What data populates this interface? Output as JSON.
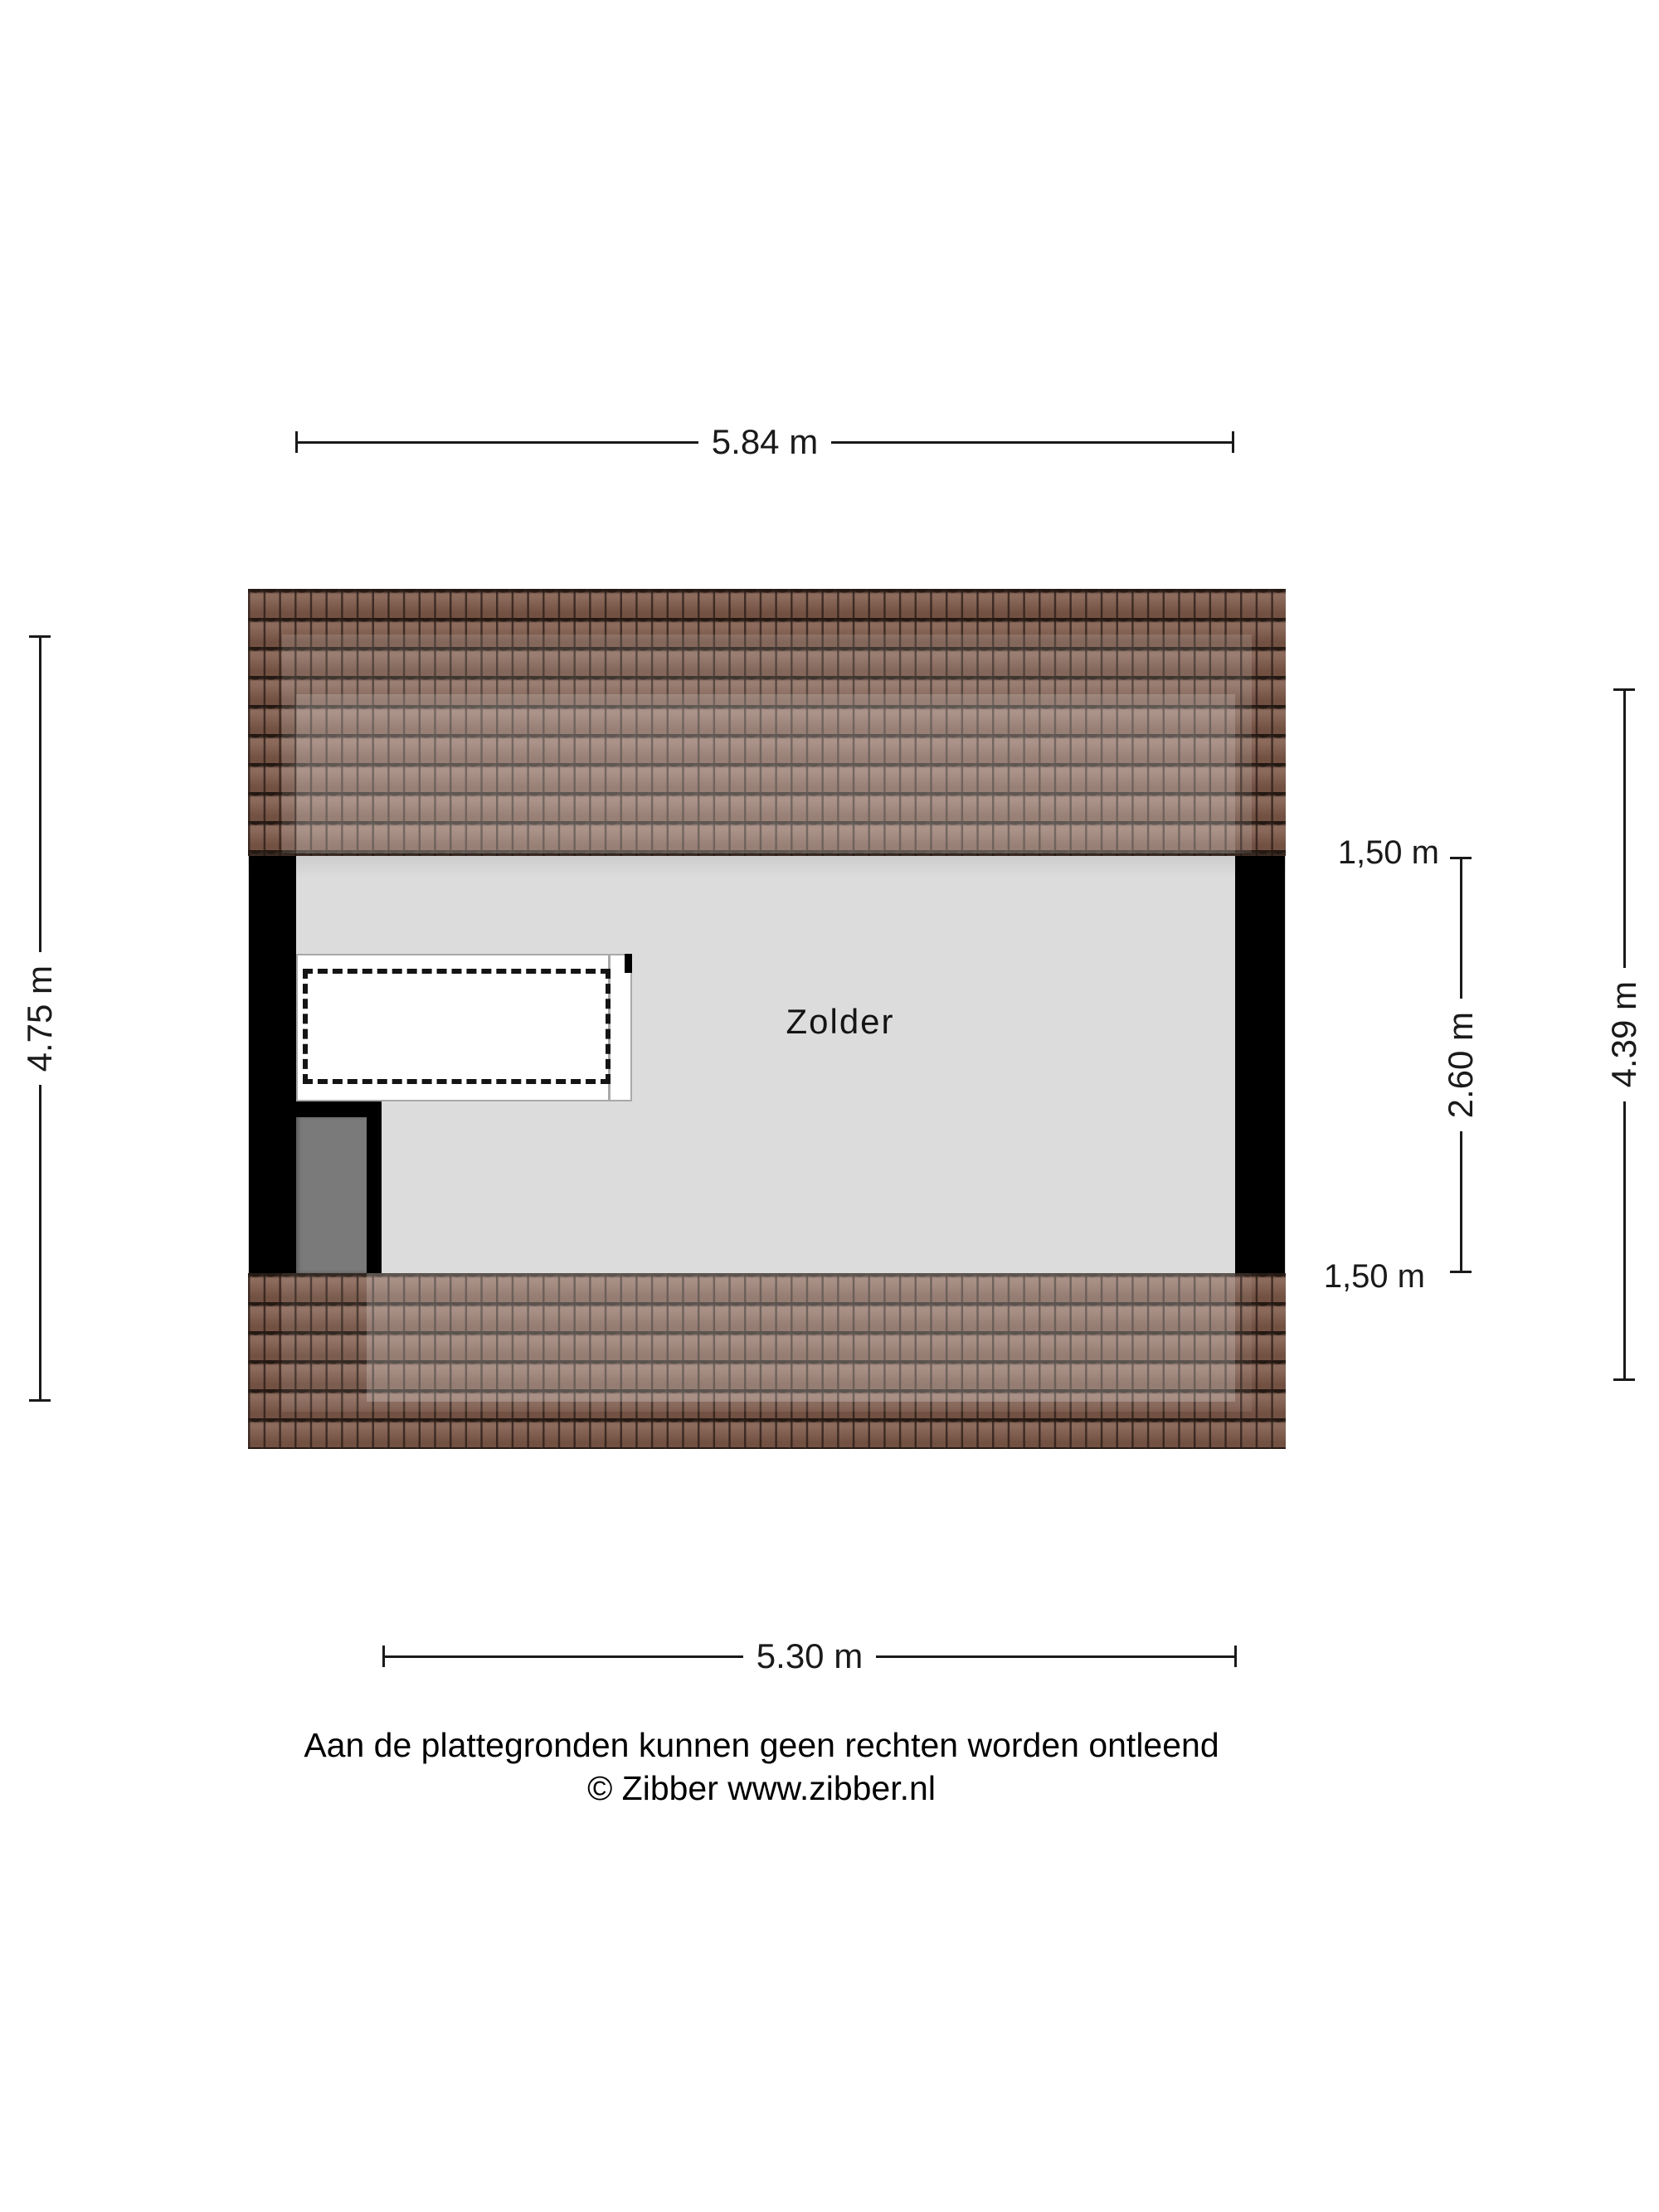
{
  "floorplan": {
    "room_label": "Zolder",
    "dimensions": {
      "top_width": "5.84 m",
      "bottom_width": "5.30 m",
      "left_height": "4.75 m",
      "right_height": "4.39 m",
      "headroom_top": "1,50 m",
      "ceiling_height": "2.60 m",
      "headroom_bottom": "1,50 m"
    },
    "colors": {
      "tile_base": "#7f5a4b",
      "tile_gap": "#2a1d17",
      "interior": "#dcdcdc",
      "wall": "#000000",
      "door": "#7a7a7a",
      "dim_line": "#1a1a1a"
    },
    "footer": {
      "disclaimer": "Aan de plattegronden kunnen geen rechten worden ontleend",
      "copyright": "© Zibber www.zibber.nl"
    }
  }
}
